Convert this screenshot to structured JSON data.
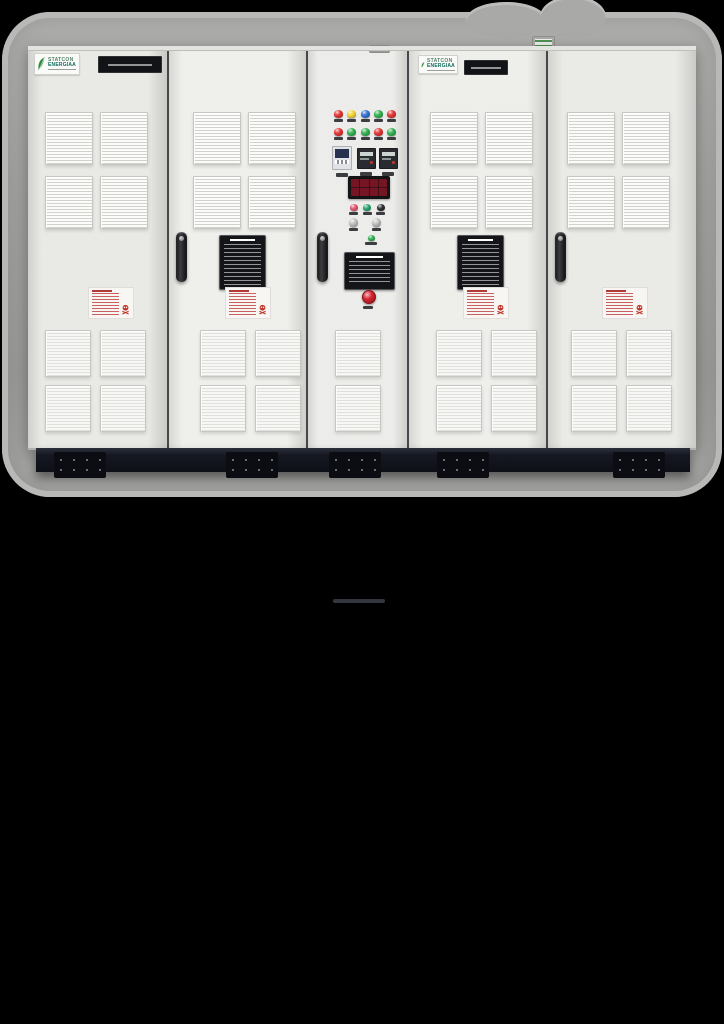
{
  "scene": {
    "background": "#000000",
    "ring_color": "#a3a3a1",
    "ring_rim_color": "#b8b8b6",
    "inspection_tag_color": "#3c8a3f"
  },
  "branding": {
    "logo_top": "STATCON",
    "logo_bottom": "ENERGIAA",
    "leaf_color": "#2e8b3a"
  },
  "cabinet": {
    "door_count": 5,
    "body_color": "#e9e9e5",
    "divider_color": "#47474b",
    "base_color": "#151822",
    "foot_color": "#0b0d13",
    "foot_count": 5,
    "handle_count": 3,
    "warning_sticker_color": "#b03a34"
  },
  "panel": {
    "lights_row1": [
      "#e03131",
      "#f2d230",
      "#2f6fd0",
      "#2fae4e",
      "#e03131"
    ],
    "lights_row2": [
      "#e03131",
      "#2fae4e",
      "#2fae4e",
      "#e03131",
      "#2fae4e"
    ],
    "small_lights": [
      "#e0536a",
      "#25a06c",
      "#2b2b2b"
    ],
    "mini_light": "#2fae4e",
    "meter_count": 3,
    "display_digit_color": "#7c1626",
    "display_bg_color": "#400f17",
    "estop_color": "#d62430"
  }
}
